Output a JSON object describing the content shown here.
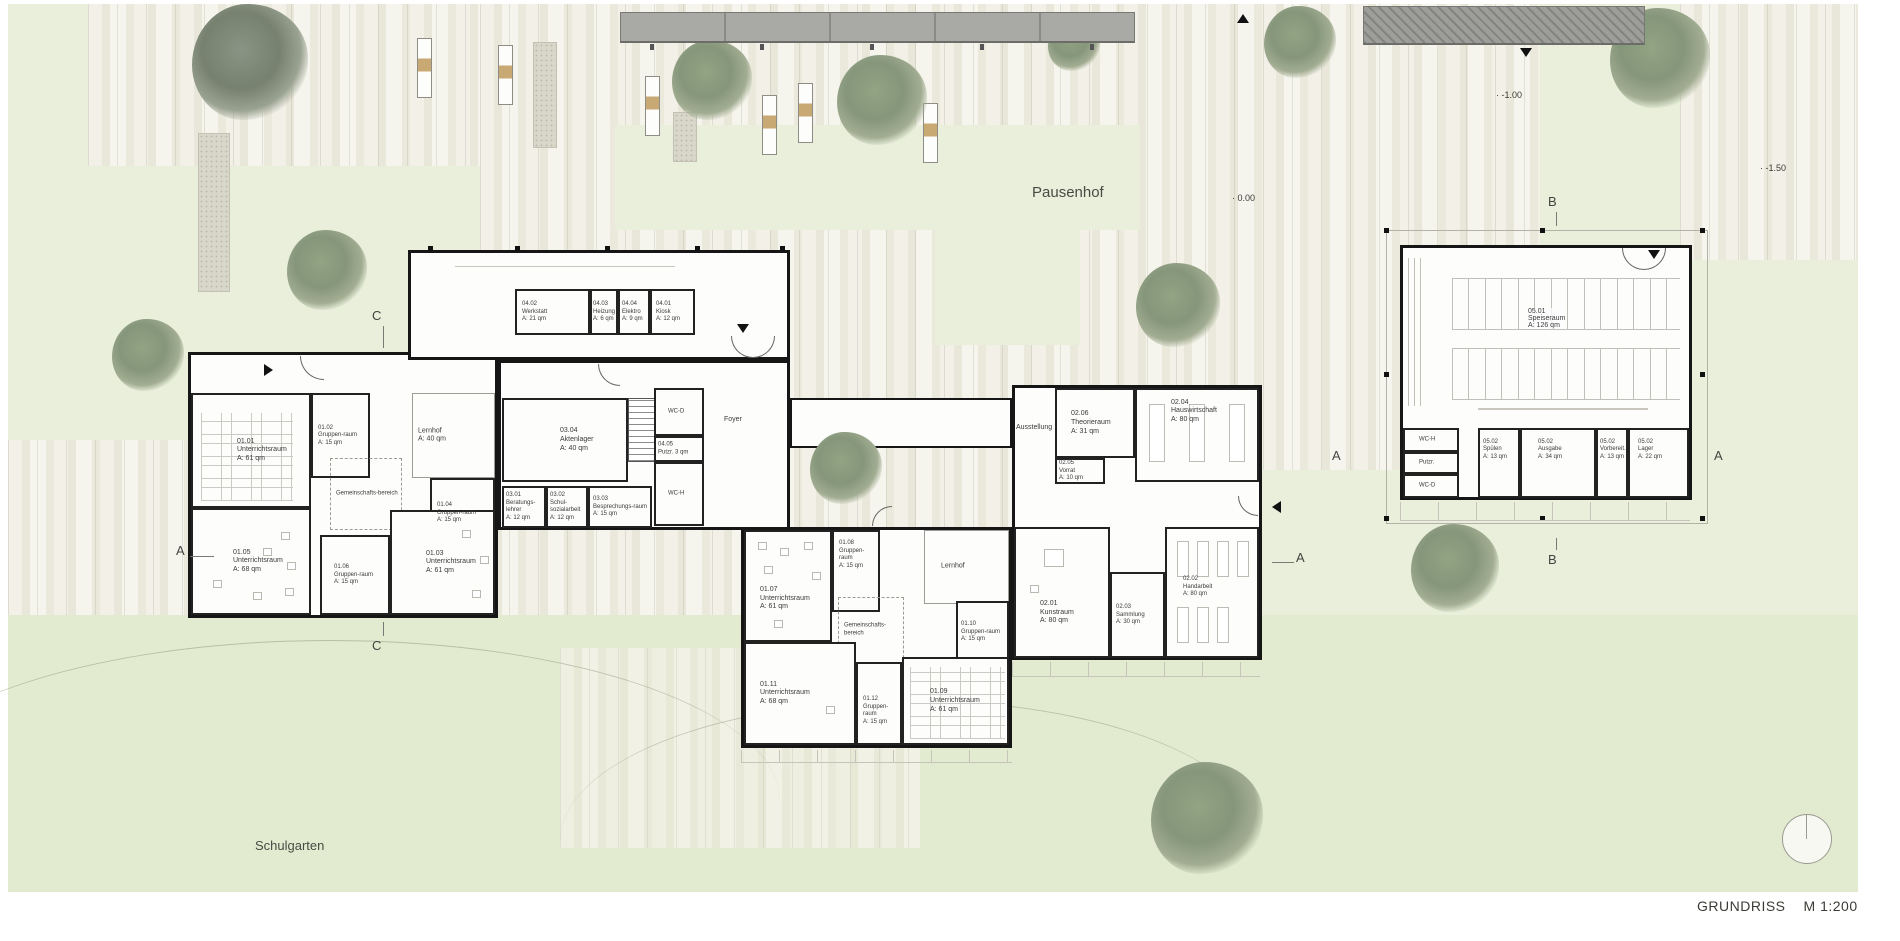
{
  "plan": {
    "title_block": {
      "title": "GRUNDRISS",
      "scale": "M 1:200"
    },
    "site_labels": {
      "pausenhof": "Pausenhof",
      "schulgarten": "Schulgarten"
    },
    "elevation_marks": [
      {
        "text": "· 0.00"
      },
      {
        "text": "· -1.00"
      },
      {
        "text": "· -1.50"
      }
    ],
    "section_marks": {
      "a": "A",
      "b": "B",
      "c": "C"
    },
    "rooms": [
      {
        "id": "01.01",
        "name": "Unterrichtsraum",
        "area": "A: 61 qm"
      },
      {
        "id": "01.02",
        "name": "Gruppen-raum",
        "area": "A: 15 qm"
      },
      {
        "name": "Lernhof",
        "area": "A: 40 qm"
      },
      {
        "name": "Gemeinschafts-bereich"
      },
      {
        "id": "01.04",
        "name": "Gruppen-raum",
        "area": "A: 15 qm"
      },
      {
        "id": "01.05",
        "name": "Unterrichtsraum",
        "area": "A: 68 qm"
      },
      {
        "id": "01.06",
        "name": "Gruppen-raum",
        "area": "A: 15 qm"
      },
      {
        "id": "01.03",
        "name": "Unterrichtsraum",
        "area": "A: 61 qm"
      },
      {
        "id": "04.02",
        "name": "Werkstatt",
        "area": "A: 21 qm"
      },
      {
        "id": "04.03",
        "name": "Heizung",
        "area": "A: 6 qm"
      },
      {
        "id": "04.04",
        "name": "Elektro",
        "area": "A: 9 qm"
      },
      {
        "id": "04.01",
        "name": "Kiosk",
        "area": "A: 12 qm"
      },
      {
        "id": "03.04",
        "name": "Aktenlager",
        "area": "A: 40 qm"
      },
      {
        "id": "03.01",
        "name": "Beratungs-lehrer",
        "area": "A: 12 qm"
      },
      {
        "id": "03.02",
        "name": "Schul-sozialarbeit",
        "area": "A: 12 qm"
      },
      {
        "id": "03.03",
        "name": "Besprechungs-raum",
        "area": "A: 15 qm"
      },
      {
        "name": "WC-D"
      },
      {
        "id": "04.05",
        "name": "Putzr. 3 qm"
      },
      {
        "name": "WC-H"
      },
      {
        "name": "Foyer"
      },
      {
        "id": "01.07",
        "name": "Unterrichtsraum",
        "area": "A: 61 qm"
      },
      {
        "id": "01.08",
        "name": "Gruppen-raum",
        "area": "A: 15 qm"
      },
      {
        "name": "Lernhof"
      },
      {
        "name": "Gemeinschafts-bereich"
      },
      {
        "id": "01.10",
        "name": "Gruppen-raum",
        "area": "A: 15 qm"
      },
      {
        "id": "01.11",
        "name": "Unterrichtsraum",
        "area": "A: 68 qm"
      },
      {
        "id": "01.12",
        "name": "Gruppen-raum",
        "area": "A: 15 qm"
      },
      {
        "id": "01.09",
        "name": "Unterrichtsraum",
        "area": "A: 61 qm"
      },
      {
        "name": "Ausstellung"
      },
      {
        "id": "02.06",
        "name": "Theorieraum",
        "area": "A: 31 qm"
      },
      {
        "id": "02.04",
        "name": "Hauswirtschaft",
        "area": "A: 80 qm"
      },
      {
        "id": "02.05",
        "name": "Vorrat",
        "area": "A: 10 qm"
      },
      {
        "id": "02.01",
        "name": "Kunstraum",
        "area": "A: 80 qm"
      },
      {
        "id": "02.03",
        "name": "Sammlung",
        "area": "A: 30 qm"
      },
      {
        "id": "02.02",
        "name": "Handarbeit",
        "area": "A: 80 qm"
      },
      {
        "id": "05.01",
        "name": "Speiseraum",
        "area": "A: 126 qm"
      },
      {
        "name": "WC-H"
      },
      {
        "name": "Putzr."
      },
      {
        "name": "WC-D"
      },
      {
        "id": "05.02",
        "name": "Spülen",
        "area": "A: 13 qm"
      },
      {
        "id": "05.02",
        "name": "Ausgabe",
        "area": "A: 34 qm"
      },
      {
        "id": "05.02",
        "name": "Vorbereit.",
        "area": "A: 13 qm"
      },
      {
        "id": "05.02",
        "name": "Lager",
        "area": "A: 22 qm"
      }
    ]
  }
}
